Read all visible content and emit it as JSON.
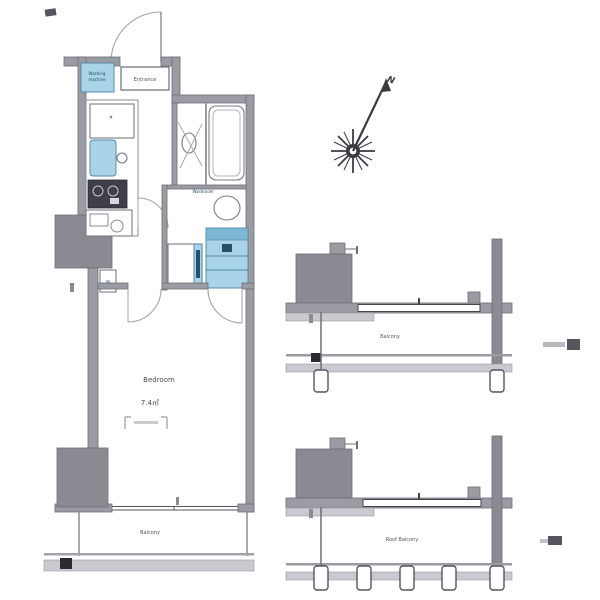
{
  "colors": {
    "background": "#ffffff",
    "wall_gray": "#9b9ba3",
    "wall_outline": "#6e6e76",
    "fixture_blue": "#a9d3e6",
    "fixture_blue_dark": "#7db7d4",
    "accent_navy": "#27506e",
    "stove_dark": "#3f3f49",
    "text": "#4a4a52"
  },
  "plan": {
    "entrance": {
      "label": "Entrance"
    },
    "washer": {
      "line1": "Washing",
      "line2": "machine"
    },
    "washroom": {
      "label": "Washroom"
    },
    "pipe_space": {
      "label": "PS"
    },
    "bedroom": {
      "label": "Bedroom",
      "area": "7.4㎡"
    },
    "balcony": {
      "label": "Balcony"
    }
  },
  "sections": {
    "balcony": {
      "label": "Balcony"
    },
    "roof_balcony": {
      "label": "Roof Balcony"
    }
  },
  "compass": {
    "north_label": "N"
  }
}
